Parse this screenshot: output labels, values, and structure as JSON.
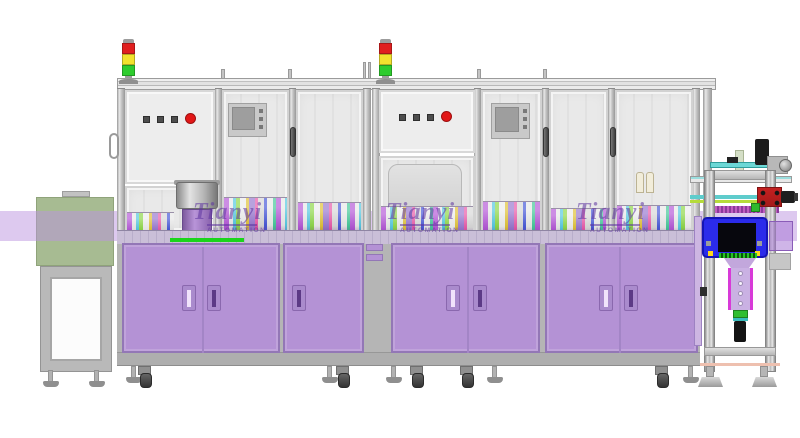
{
  "watermark": {
    "brand": "Tianyi",
    "subtitle": "AUTOMATION"
  },
  "colors": {
    "cabinet_purple": "#b492d5",
    "cabinet_border": "#9377b6",
    "band_purple": "rgba(187,148,224,0.5)",
    "conveyor_green": "#a7bb92",
    "signal_red": "#e01f1f",
    "signal_yellow": "#f2e22e",
    "signal_green": "#2ecc2e",
    "estop_red": "#e21717",
    "housing_blue": "#2b2bea",
    "accent_green": "#1bd41b"
  }
}
